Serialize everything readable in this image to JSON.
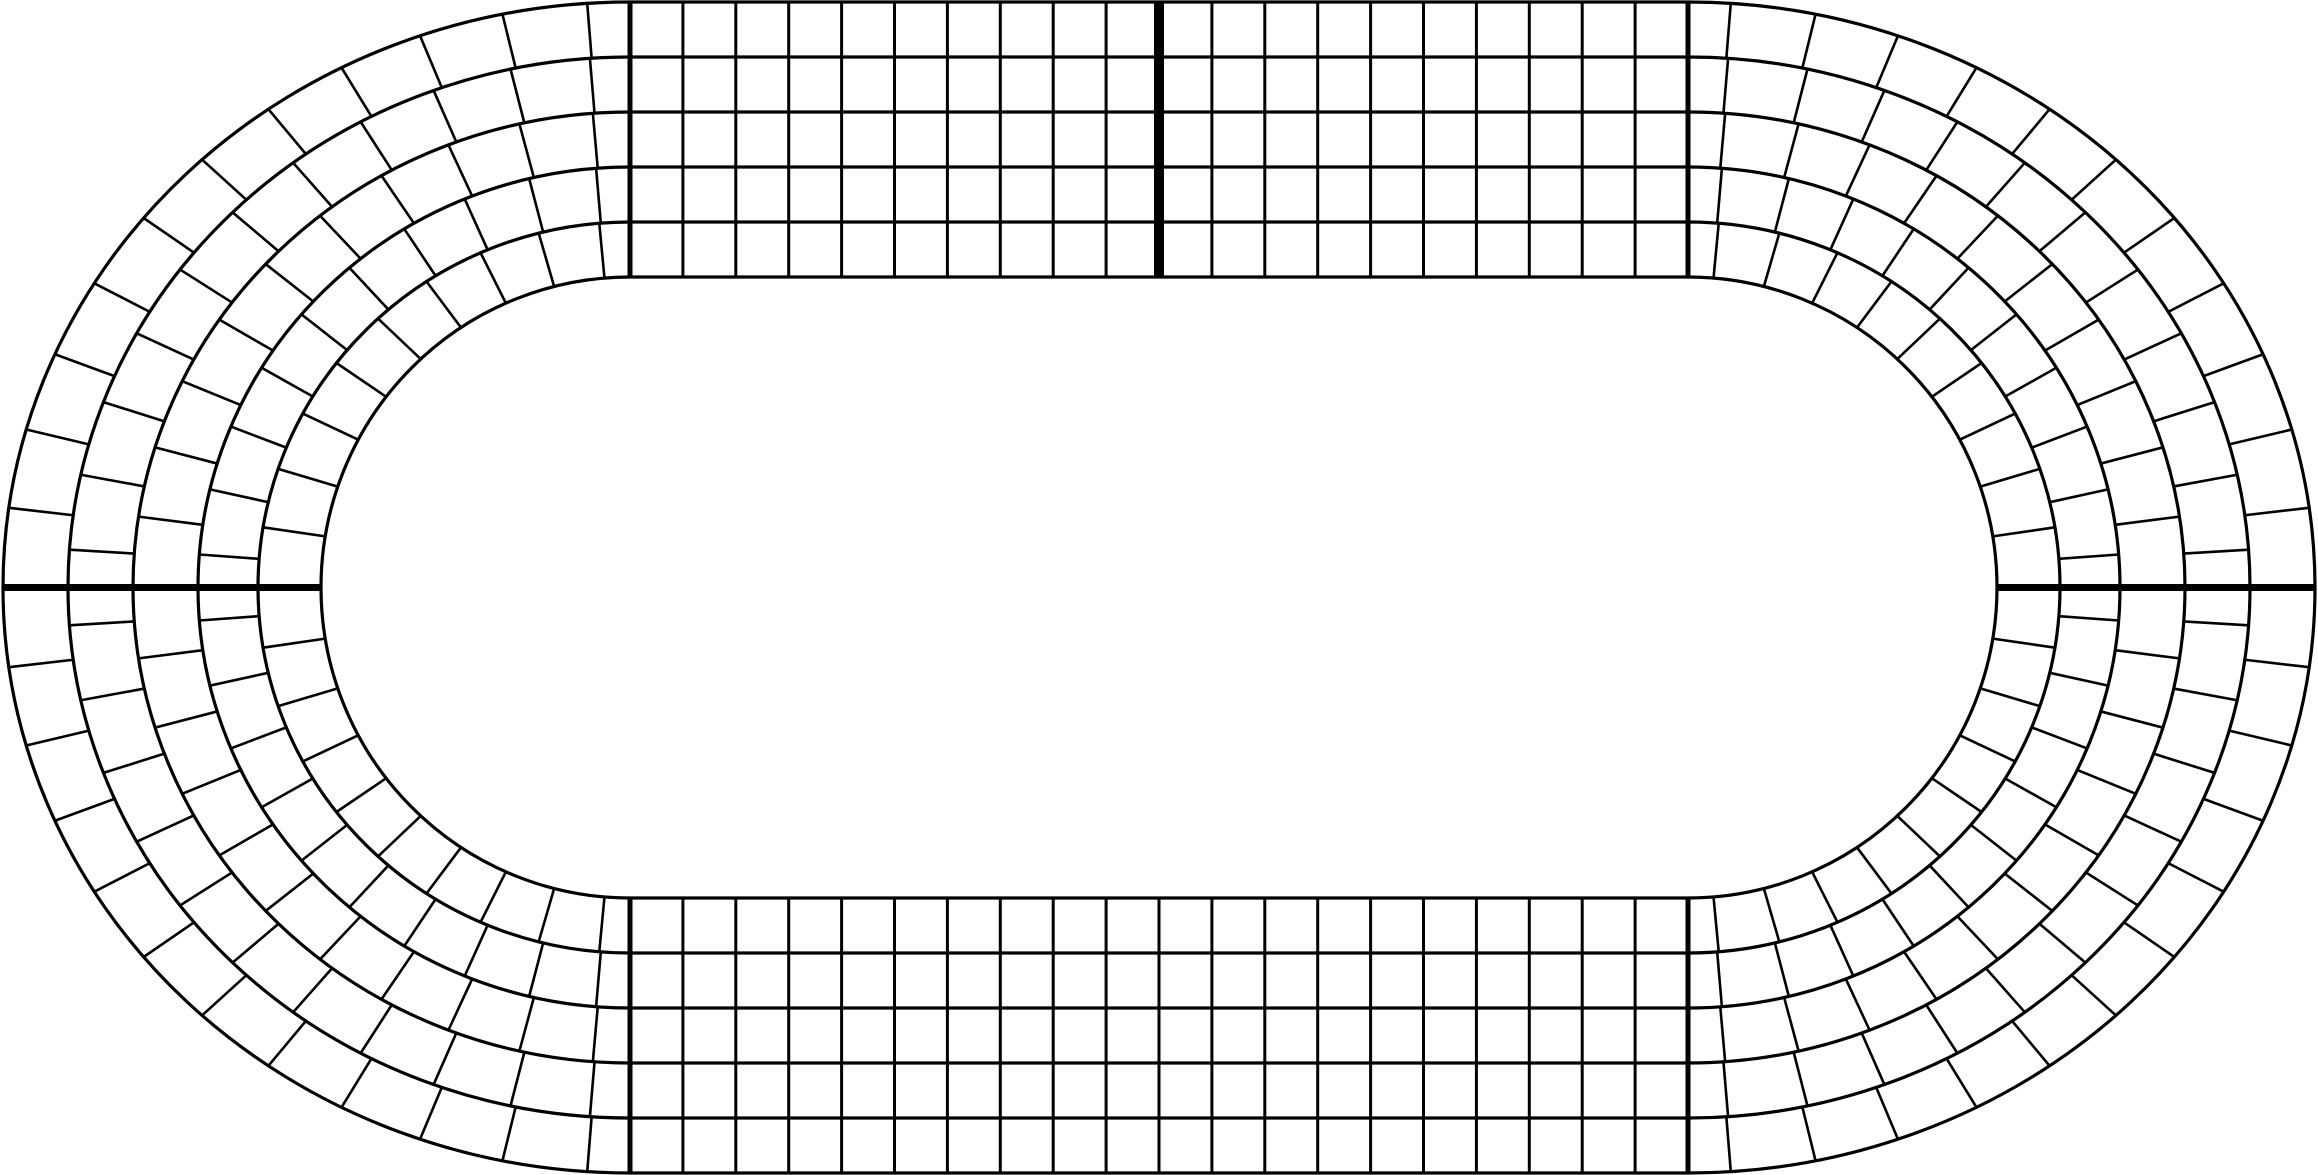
{
  "figure": {
    "description": "Oval stadium track diagram with 5 concentric lanes divided into grid cells; straight sections have aligned rectangular columns, curved sections have per-lane staggered wedge cells (brick pattern)",
    "background_color": "#ffffff",
    "stroke_color": "#000000",
    "width": 2318,
    "height": 1175
  },
  "track": {
    "lanes": 5,
    "center_y": 587.5,
    "left_curve_center_x": 630,
    "right_curve_center_x": 1688,
    "boundary_semi_axes_x": [
      627,
      562,
      497,
      432,
      372,
      309
    ],
    "boundary_semi_axes_y": [
      585.5,
      530.5,
      475.5,
      420.5,
      365.5,
      310.5
    ],
    "straight": {
      "columns_per_straight": 20,
      "column_line_width": 3,
      "has_top_straight": true,
      "has_bottom_straight": true
    },
    "curves": {
      "cells_per_half_curve_by_lane": [
        23,
        22,
        21,
        20,
        19
      ],
      "entry_phase_fraction": 0.5,
      "divider_line_width": 2.6
    },
    "lane_boundary_line_width": 3.2,
    "marker_lines": {
      "start_finish": {
        "position": "top-center",
        "x": 1159,
        "line_width": 10,
        "on_bottom": false
      },
      "left_middle": {
        "y": 587.5,
        "line_width": 7
      },
      "right_middle": {
        "y": 587.5,
        "line_width": 7
      },
      "transition_line_width": 5,
      "transitions": [
        "top-left",
        "top-right",
        "bottom-left",
        "bottom-right"
      ]
    }
  }
}
